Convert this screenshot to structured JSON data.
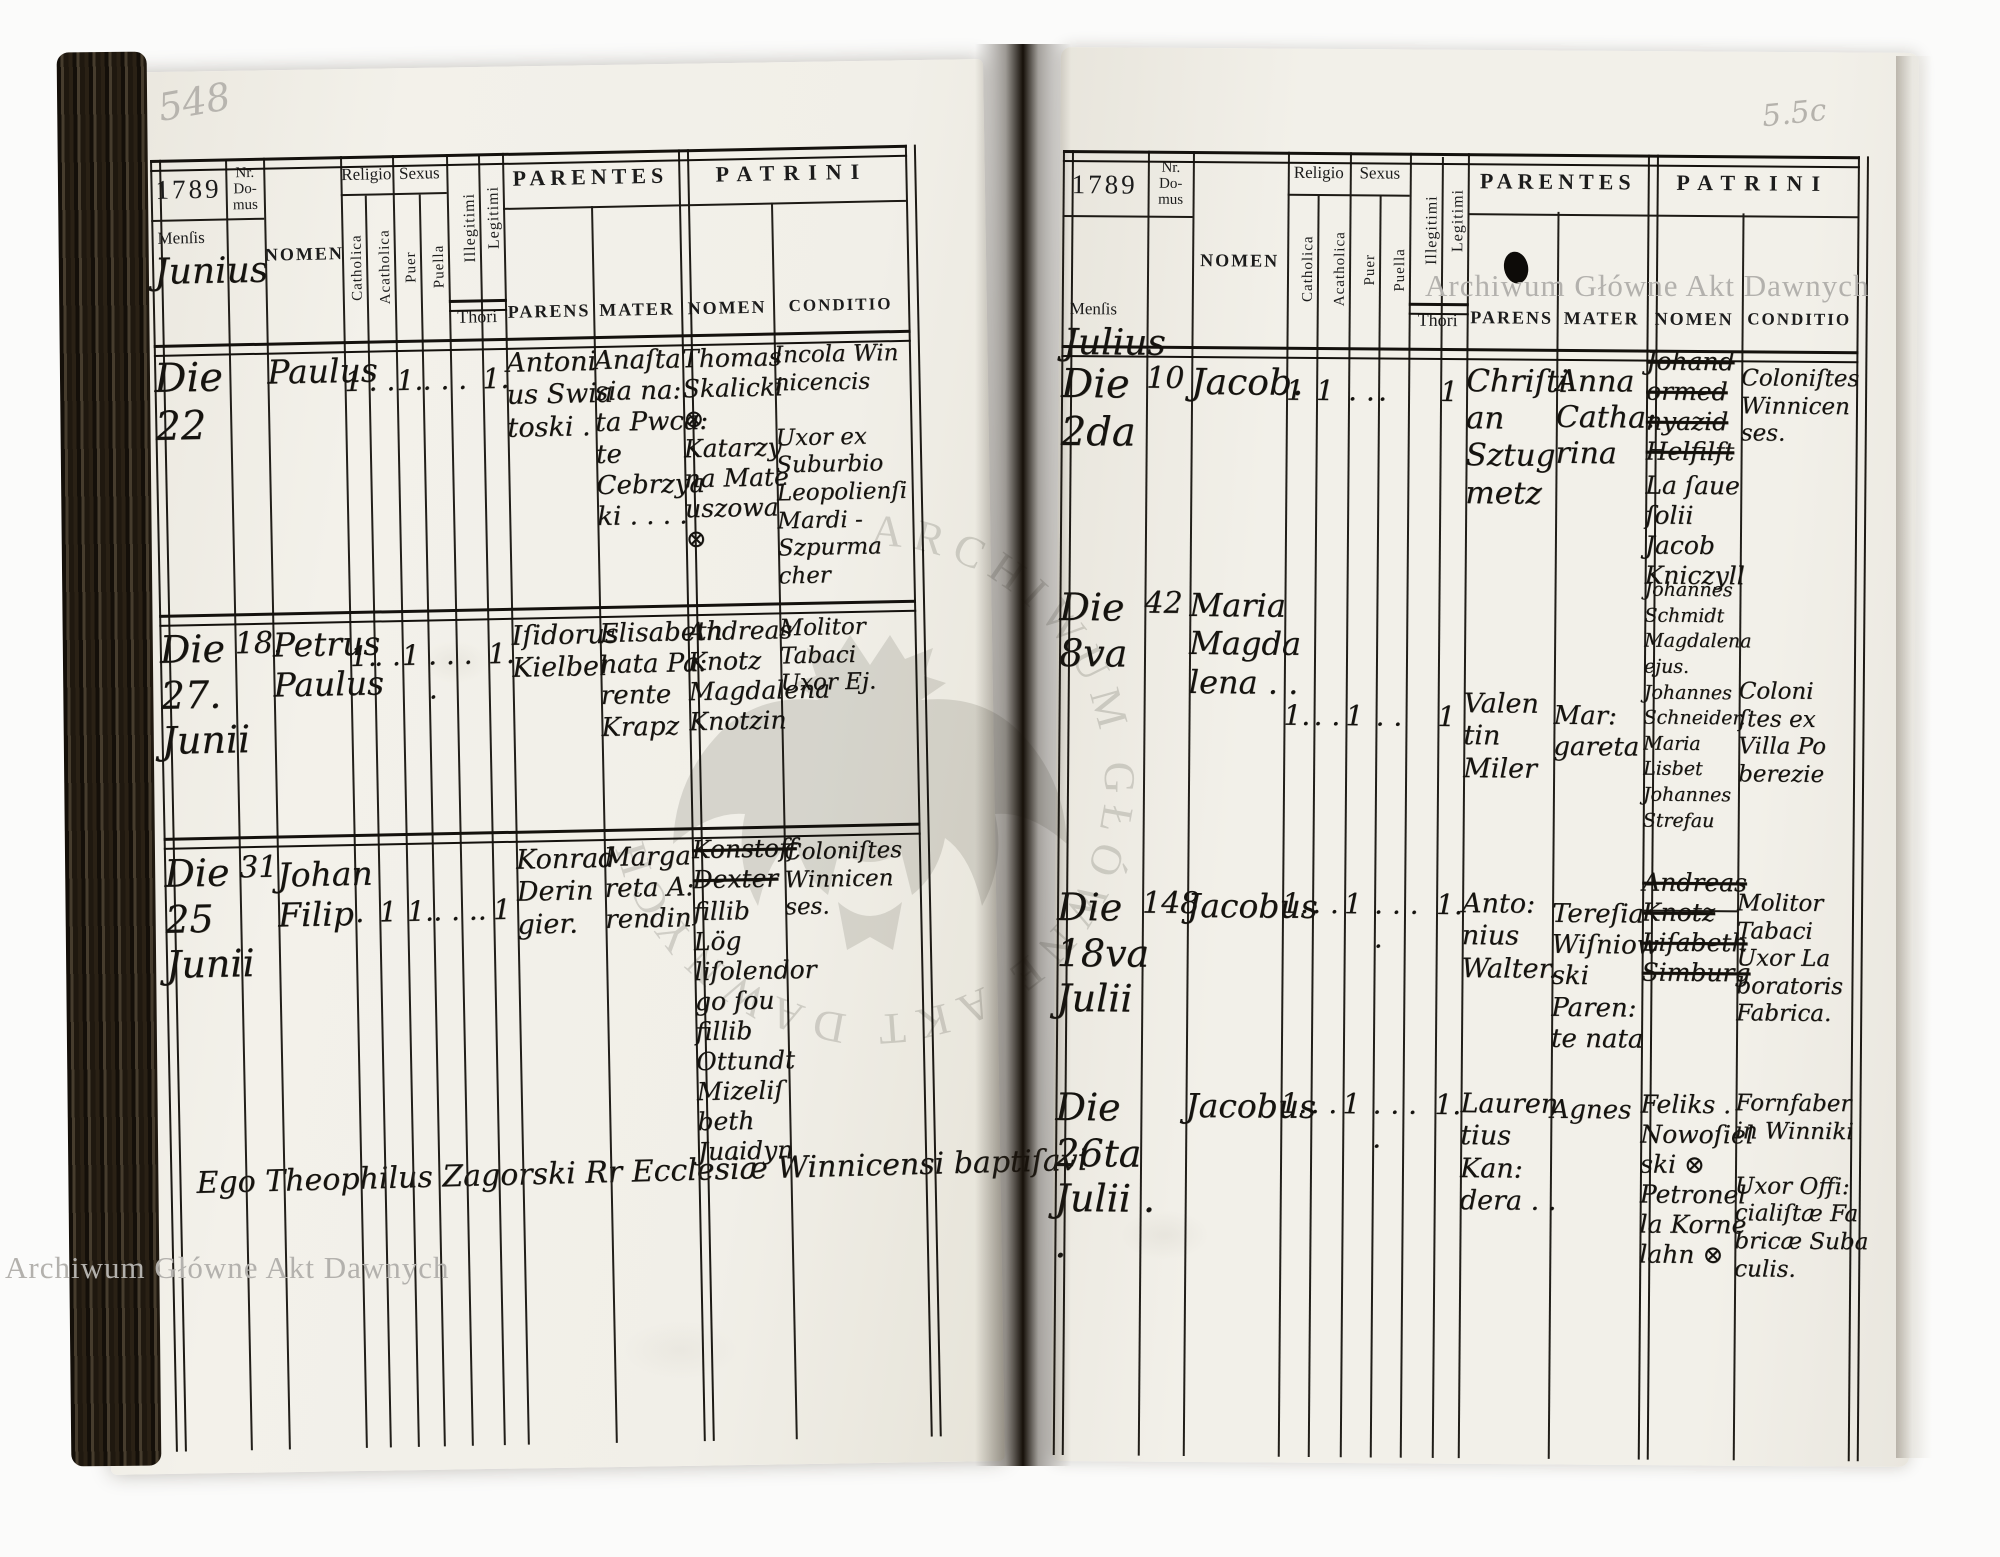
{
  "header_labels": {
    "nr_domus": "Nr.\nDo-\nmus",
    "mensis": "Menſis",
    "nomen": "NOMEN",
    "religio": "Religio",
    "sexus": "Sexus",
    "catholica": "Catholica",
    "acatholica": "Acatholica",
    "puer": "Puer",
    "puella": "Puella",
    "illegitimi": "Illegitimi",
    "legitimi": "Legitimi",
    "thori": "Thori",
    "parentes": "PARENTES",
    "parens": "PARENS",
    "mater": "MATER",
    "patrini": "PATRINI",
    "patrini_nomen": "NOMEN",
    "conditio": "CONDITIO"
  },
  "page_marks": {
    "watermark_top_right": "Archiwum Główne Akt Dawnych",
    "watermark_bottom_left": "Archiwum Główne Akt Dawnych",
    "watermark_center": "ARCHIWUM GŁÓWNE AKT DAWNYCH"
  },
  "left_page": {
    "folio": "548",
    "year": "1789",
    "month": "Junius",
    "footer": "Ego Theophilus Zagorski Rr Ecclesiæ Winnicensi baptiſavi",
    "rows": [
      {
        "die": "Die\n22",
        "nr": "",
        "nomen": "Paulus",
        "cath": "1",
        "acath": ". .",
        "puer": "1.",
        "puella": ". . .",
        "illeg": "",
        "legit": "1.",
        "parens": "Antoni\nus Swia\ntoski .",
        "mater": "Anaſta\nsia na:\nta Pwca:\nte Cebrzya\nki . . . .",
        "p_nomen_struck": "",
        "p_nomen": "Thomas\nSkalicki\n⊗\nKatarzy\nna Mate\nuszowa\n⊗",
        "conditio": "Incola Win\nnicencis\n\nUxor ex\nSuburbio\nLeopolienſi\nMardi -\nSzpurma\ncher"
      },
      {
        "die": "Die\n27.\nJunii",
        "nr": "18.",
        "nomen": "Petrus\nPaulus",
        "cath": "1.",
        "acath": ". .",
        "puer": "1",
        "puella": ". . . .",
        "illeg": "",
        "legit": "1.",
        "parens": "Iſidorus\nKielbel",
        "mater": "Elisabeth\nnata Pa:\nrente Krapz",
        "p_nomen_struck": "",
        "p_nomen": "Andreas\nKnotz\nMagdalena\nKnotzin",
        "conditio": "Molitor\nTabaci\nUxor Ej."
      },
      {
        "die": "Die\n25\nJunii",
        "nr": "31",
        "nomen": "Johan\nFilip",
        "cath": ".",
        "acath": "1",
        "puer": "1.",
        "puella": ". . ..",
        "illeg": "",
        "legit": "1",
        "parens": "Konrad\nDerin\ngier.",
        "mater": "Marga\nreta A:\nrendin",
        "p_nomen_struck": "Konstoff\nDexter",
        "p_nomen": "fillib\nLög\nliſolendor\ngo ſou\nfillib\nOttundt\nMizeliſ\nbeth\nJuaidyn",
        "conditio": "Coloniſtes\nWinnicen\nses."
      }
    ]
  },
  "right_page": {
    "folio": "5.5c",
    "year": "1789",
    "month": "Julius",
    "footer": "",
    "rows": [
      {
        "die": "Die\n2da",
        "nr": "10",
        "nomen": "Jacob.",
        "cath": "1",
        "acath": "1",
        "puer": ". .",
        "puella": ".",
        "illeg": "",
        "legit": "1",
        "parens": "Chriſti\nan\nSztug\nmetz",
        "mater": "Anna\nCatha:\nrina",
        "p_nomen_struck": "Johand\normed\nnyazid\nHelfilft",
        "p_nomen": "La ſaue\nſolii\nJacob\nKniczyll",
        "conditio": "Coloniſtes\nWinnicen\nses."
      },
      {
        "die": "Die\n8va",
        "nr": "42",
        "nomen": "Maria\nMagda\nlena . .",
        "cath": "1.",
        "acath": ". .",
        "puer": "1",
        "puella": ". .",
        "illeg": "",
        "legit": "1",
        "parens": "Valen\ntin\nMiler",
        "mater": "Mar:\ngareta",
        "p_nomen_struck": "",
        "p_nomen": "Johannes\nSchmidt\nMagdalena\nejus.\nJohannes\nSchneider.\nMaria\nLisbet\nJohannes\nStrefau",
        "conditio": "Coloni\nſtes ex\nVilla Po\nberezie"
      },
      {
        "die": "Die\n18va\nJulii",
        "nr": "148",
        "nomen": "Jacobus",
        "cath": "1.",
        "acath": ". .",
        "puer": "1",
        "puella": ". . . .",
        "illeg": "",
        "legit": "1.",
        "parens": "Anto:\nnius\nWalter.",
        "mater": "Tereſia\nWiſniow\nski Paren:\nte nata",
        "p_nomen_struck": "Andreas\nKnotz\nLiſabeth\nSimburg",
        "p_nomen": "",
        "conditio": "Molitor\nTabaci\nUxor La\nboratoris\nFabrica."
      },
      {
        "die": "Die\n26ta\nJulii . .",
        "nr": "",
        "nomen": "Jacobus",
        "cath": "1.",
        "acath": ". .",
        "puer": "1",
        "puella": ". . . .",
        "illeg": "",
        "legit": "1.",
        "parens": "Lauren\ntius Kan:\ndera . .",
        "mater": "Agnes",
        "p_nomen_struck": "",
        "p_nomen": "Feliks .\nNowoſiel\nski ⊗\nPetronel\nla Korne\nlahn ⊗",
        "conditio": "Fornfaber\nin Winniki\n\nUxor Offi:\ncialiſtæ Fa\nbricæ Suba\nculis."
      }
    ]
  }
}
